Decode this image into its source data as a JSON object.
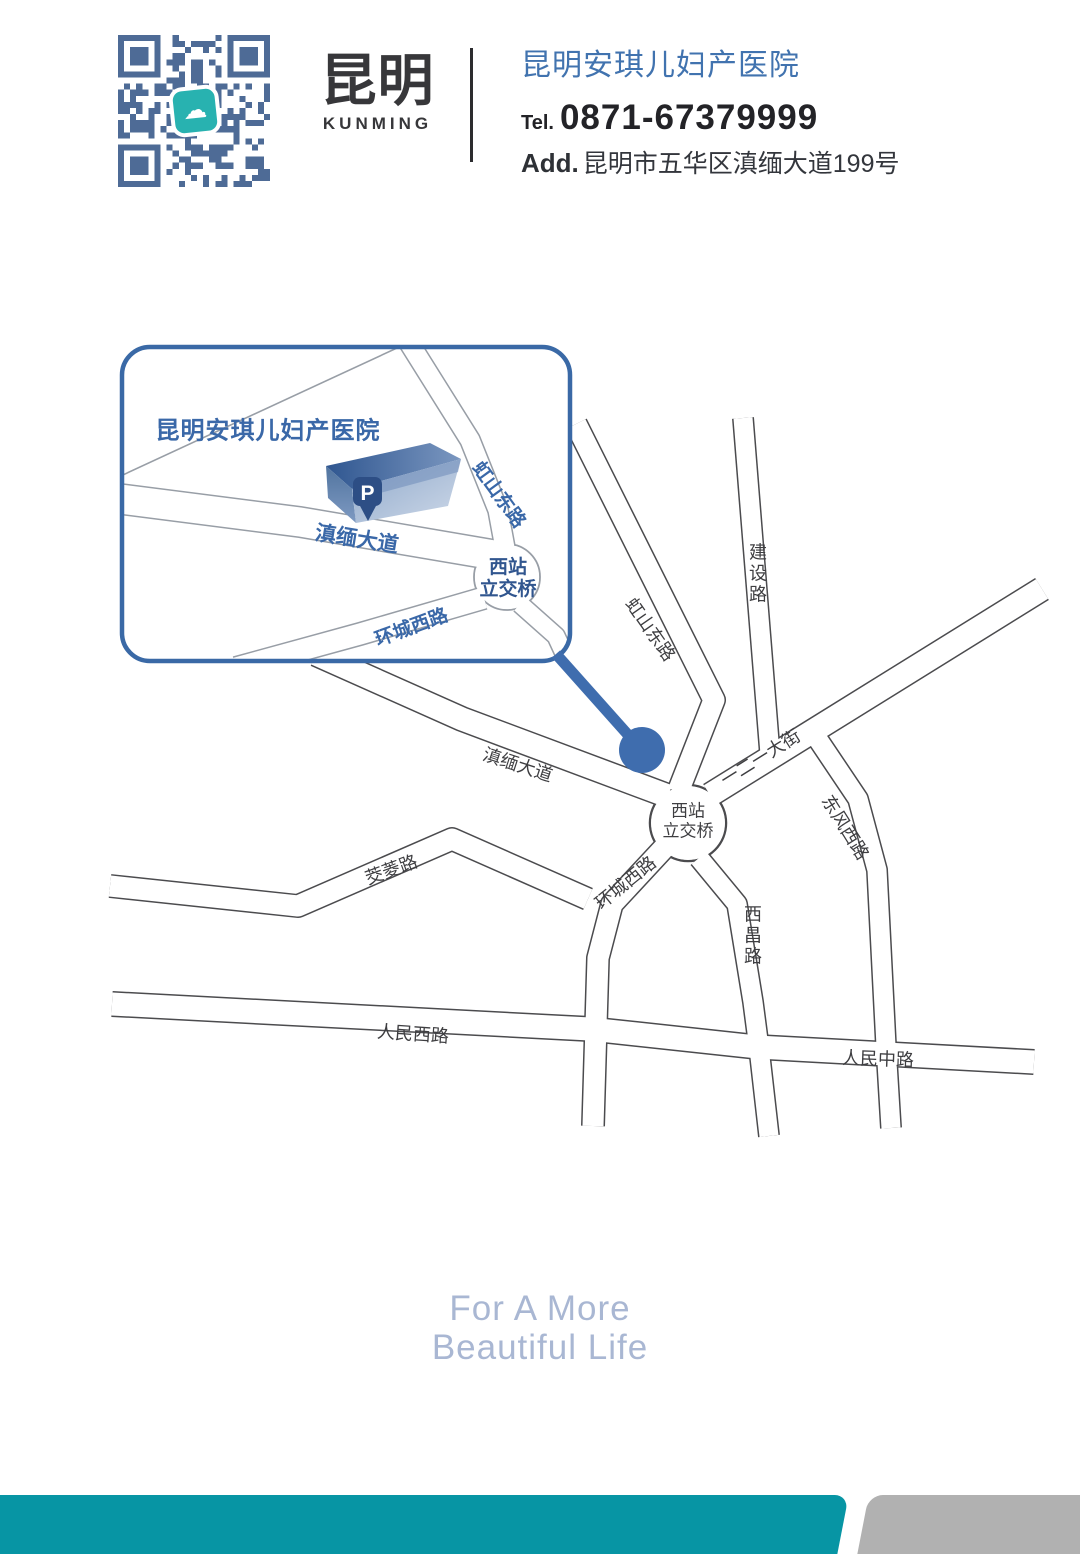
{
  "header": {
    "brand_city": "昆明",
    "brand_city_en": "KUNMING",
    "hospital_name": "昆明安琪儿妇产医院",
    "tel_label": "Tel.",
    "tel_number": "0871-67379999",
    "add_label": "Add.",
    "address": "昆明市五华区滇缅大道199号"
  },
  "inset_map": {
    "title": "昆明安琪儿妇产医院",
    "parking": "P",
    "labels": {
      "dianmian": "滇缅大道",
      "hongshan": "虹山东路",
      "xizhan1": "西站",
      "xizhan2": "立交桥",
      "huancheng": "环城西路"
    }
  },
  "main_map": {
    "labels": {
      "dianmian": "滇缅大道",
      "hongshan": "虹山东路",
      "jianshe": "建设路",
      "yiereyi": "一二一大街",
      "dongfeng": "东风西路",
      "xizhan1": "西站",
      "xizhan2": "立交桥",
      "huancheng": "环城西路",
      "xichang": "西昌路",
      "jiaoling": "茭菱路",
      "renmin_xi": "人民西路",
      "renmin_zhong": "人民中路"
    }
  },
  "slogan": {
    "line1": "For A More",
    "line2": "Beautiful Life"
  },
  "colors": {
    "accent_blue": "#3a68a8",
    "title_blue": "#4173af",
    "map_ink": "#3e3e41",
    "qr_module": "#4e6b96",
    "qr_logo_teal": "#28b2b0",
    "marker_blue": "#3f6dae",
    "slogan_blue": "#a9b7d3",
    "footer_teal": "#0795a4",
    "footer_gray": "#b1b1b1"
  }
}
